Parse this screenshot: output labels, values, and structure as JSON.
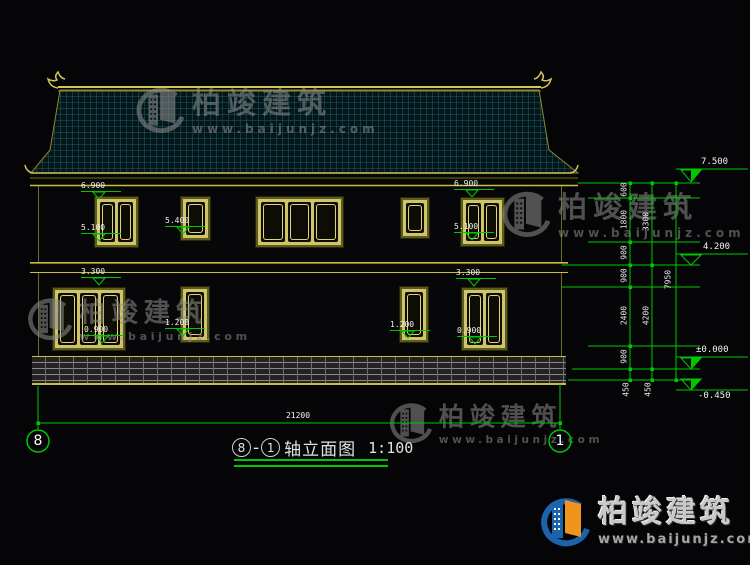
{
  "title": {
    "axis_left": "8",
    "separator": "-",
    "axis_right": "1",
    "label": "轴立面图",
    "scale": "1:100"
  },
  "axes": {
    "left_bubble": "8",
    "right_bubble": "1"
  },
  "overall_width_dim": "21200",
  "watermark": {
    "brand": "柏竣建筑",
    "url": "www.baijunjz.com"
  },
  "brand_logo": {
    "brand": "柏竣建筑",
    "url": "www.baijunjz.com"
  },
  "colors": {
    "cad_yellow": "#c9bd4a",
    "cad_green": "#00c800",
    "tile_line": "#1c5f66",
    "logo_blue": "#1b64ad",
    "logo_orange": "#f0941e",
    "watermark_gray": "#8e8e8e"
  },
  "elevation_labels": [
    {
      "text": "6.900",
      "x": 81,
      "y": 181
    },
    {
      "text": "5.100",
      "x": 81,
      "y": 223
    },
    {
      "text": "5.400",
      "x": 165,
      "y": 216
    },
    {
      "text": "6.900",
      "x": 454,
      "y": 179
    },
    {
      "text": "5.100",
      "x": 454,
      "y": 222
    },
    {
      "text": "3.300",
      "x": 81,
      "y": 267
    },
    {
      "text": "0.900",
      "x": 84,
      "y": 325
    },
    {
      "text": "1.200",
      "x": 165,
      "y": 318
    },
    {
      "text": "1.200",
      "x": 390,
      "y": 320
    },
    {
      "text": "3.300",
      "x": 456,
      "y": 268
    },
    {
      "text": "0.900",
      "x": 457,
      "y": 326
    }
  ],
  "chain_labels": [
    {
      "text": "600",
      "x": 624,
      "y": 190
    },
    {
      "text": "1800",
      "x": 624,
      "y": 220
    },
    {
      "text": "900",
      "x": 624,
      "y": 253
    },
    {
      "text": "900",
      "x": 624,
      "y": 276
    },
    {
      "text": "2400",
      "x": 624,
      "y": 316
    },
    {
      "text": "900",
      "x": 624,
      "y": 357
    },
    {
      "text": "450",
      "x": 626,
      "y": 390
    },
    {
      "text": "3300",
      "x": 646,
      "y": 222
    },
    {
      "text": "4200",
      "x": 646,
      "y": 316
    },
    {
      "text": "450",
      "x": 648,
      "y": 390
    },
    {
      "text": "7950",
      "x": 668,
      "y": 280
    }
  ],
  "elevation_markers": [
    {
      "text": "7.500",
      "x": 701,
      "y": 157
    },
    {
      "text": "4.200",
      "x": 703,
      "y": 242
    },
    {
      "text": "±0.000",
      "x": 696,
      "y": 345
    },
    {
      "text": "-0.450",
      "x": 698,
      "y": 391
    }
  ],
  "windows": [
    {
      "x": 95,
      "y": 197,
      "w": 43,
      "h": 50,
      "panes": 2
    },
    {
      "x": 181,
      "y": 197,
      "w": 29,
      "h": 43,
      "panes": 1
    },
    {
      "x": 256,
      "y": 197,
      "w": 87,
      "h": 50,
      "panes": 3
    },
    {
      "x": 401,
      "y": 198,
      "w": 28,
      "h": 40,
      "panes": 1
    },
    {
      "x": 461,
      "y": 198,
      "w": 43,
      "h": 48,
      "panes": 2
    },
    {
      "x": 53,
      "y": 288,
      "w": 72,
      "h": 62,
      "panes": 3
    },
    {
      "x": 181,
      "y": 287,
      "w": 28,
      "h": 55,
      "panes": 1
    },
    {
      "x": 400,
      "y": 287,
      "w": 28,
      "h": 55,
      "panes": 1
    },
    {
      "x": 462,
      "y": 288,
      "w": 45,
      "h": 62,
      "panes": 2
    }
  ],
  "watermarks": [
    {
      "x": 132,
      "y": 84,
      "scale": 1
    },
    {
      "x": 498,
      "y": 188,
      "scale": 1
    },
    {
      "x": 24,
      "y": 295,
      "scale": 0.92
    },
    {
      "x": 386,
      "y": 400,
      "scale": 0.88
    }
  ]
}
